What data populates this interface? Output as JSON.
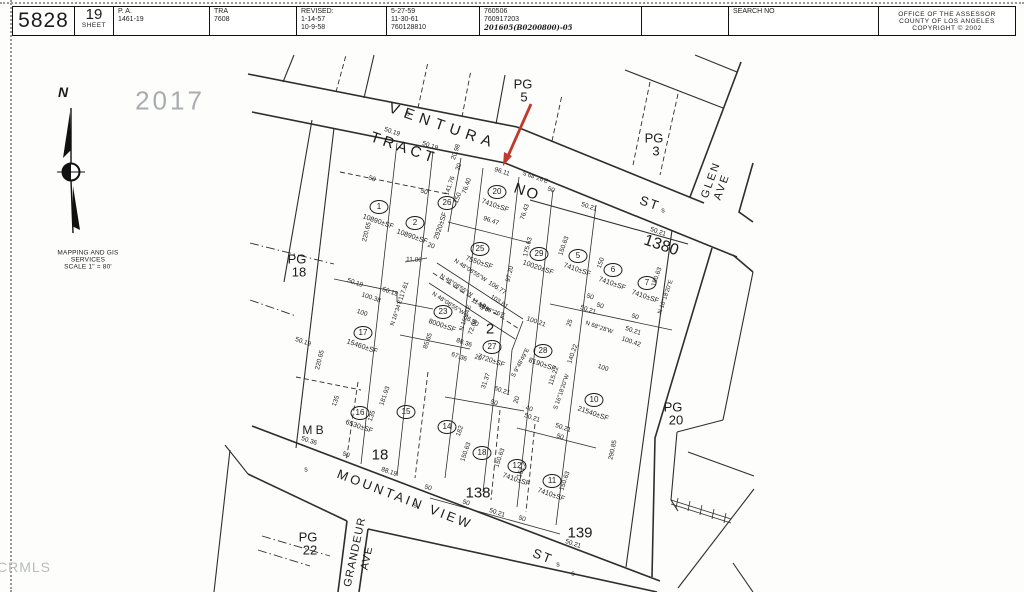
{
  "header": {
    "cells": [
      {
        "w": 62,
        "lines": [
          {
            "t": "5828",
            "cls": "xl"
          }
        ]
      },
      {
        "w": 39,
        "lines": [
          {
            "t": "19",
            "cls": "lg"
          },
          {
            "t": "SHEET",
            "cls": "cap"
          }
        ]
      },
      {
        "w": 96,
        "lines": [
          {
            "t": "P. A."
          },
          {
            "t": "1461-19"
          }
        ]
      },
      {
        "w": 87,
        "lines": [
          {
            "t": "TRA"
          },
          {
            "t": "7608"
          }
        ]
      },
      {
        "w": 90,
        "lines": [
          {
            "t": "REVISED:"
          },
          {
            "t": "1-14-57"
          },
          {
            "t": "10-9-58"
          }
        ]
      },
      {
        "w": 93,
        "lines": [
          {
            "t": "5-27-59"
          },
          {
            "t": "11-30-61"
          },
          {
            "t": "760128810"
          }
        ]
      },
      {
        "w": 162,
        "lines": [
          {
            "t": "760506"
          },
          {
            "t": "760917203"
          },
          {
            "t": "201605(B0200800)-05",
            "cls": "hand"
          }
        ]
      },
      {
        "w": 87,
        "lines": []
      },
      {
        "w": 150,
        "lines": [
          {
            "t": "SEARCH NO"
          }
        ]
      },
      {
        "w": 136,
        "align": "center",
        "lines": [
          {
            "t": "OFFICE OF THE ASSESSOR",
            "cls": "cap"
          },
          {
            "t": "COUNTY OF LOS ANGELES",
            "cls": "cap"
          },
          {
            "t": "COPYRIGHT © 2002",
            "cls": "cap"
          }
        ]
      }
    ]
  },
  "compass": {
    "north": "N",
    "caption1": "MAPPING AND GIS",
    "caption2": "SERVICES",
    "caption3": "SCALE 1\" = 80'"
  },
  "stamp": "2017",
  "watermark": "CRMLS",
  "map": {
    "arrow_color": "#c0392b",
    "labels": [
      {
        "t": "VENTURA",
        "x": 443,
        "y": 126,
        "r": 19,
        "k": "st",
        "s": 15,
        "ls": 6
      },
      {
        "t": "ST",
        "x": 650,
        "y": 203,
        "r": 19,
        "k": "st",
        "s": 13
      },
      {
        "t": "TRACT",
        "x": 404,
        "y": 148,
        "r": 19,
        "k": "st",
        "s": 15,
        "ls": 4
      },
      {
        "t": "NO",
        "x": 527,
        "y": 192,
        "r": 19,
        "k": "st",
        "s": 15
      },
      {
        "t": "MOUNTAIN VIEW",
        "x": 405,
        "y": 499,
        "r": 21,
        "k": "st",
        "s": 13,
        "ls": 3
      },
      {
        "t": "ST",
        "x": 543,
        "y": 556,
        "r": 21,
        "k": "st",
        "s": 13
      },
      {
        "t": "GLEN",
        "x": 711,
        "y": 180,
        "r": -70,
        "k": "st",
        "s": 11,
        "ls": 2
      },
      {
        "t": "AVE",
        "x": 722,
        "y": 187,
        "r": -70,
        "k": "st",
        "s": 11,
        "ls": 2
      },
      {
        "t": "GRANDEUR",
        "x": 355,
        "y": 552,
        "r": -78,
        "k": "st",
        "s": 11,
        "ls": 1
      },
      {
        "t": "AVE",
        "x": 367,
        "y": 558,
        "r": -78,
        "k": "st",
        "s": 11,
        "ls": 1
      },
      {
        "t": "PG",
        "x": 523,
        "y": 84,
        "k": "pg"
      },
      {
        "t": "5",
        "x": 524,
        "y": 97,
        "k": "pg"
      },
      {
        "t": "PG",
        "x": 654,
        "y": 138,
        "k": "pg"
      },
      {
        "t": "3",
        "x": 656,
        "y": 151,
        "k": "pg"
      },
      {
        "t": "PG",
        "x": 297,
        "y": 259,
        "k": "pg"
      },
      {
        "t": "18",
        "x": 299,
        "y": 272,
        "k": "pg"
      },
      {
        "t": "PG",
        "x": 673,
        "y": 407,
        "k": "pg"
      },
      {
        "t": "20",
        "x": 676,
        "y": 420,
        "k": "pg"
      },
      {
        "t": "PG",
        "x": 308,
        "y": 537,
        "k": "pg"
      },
      {
        "t": "22",
        "x": 310,
        "y": 550,
        "k": "pg"
      },
      {
        "t": "1380",
        "x": 661,
        "y": 246,
        "r": 19,
        "k": "blk",
        "s": 16
      },
      {
        "t": "2",
        "x": 490,
        "y": 329,
        "k": "blk"
      },
      {
        "t": "18",
        "x": 380,
        "y": 455,
        "k": "blk"
      },
      {
        "t": "138",
        "x": 478,
        "y": 493,
        "k": "blk"
      },
      {
        "t": "139",
        "x": 580,
        "y": 533,
        "k": "blk"
      },
      {
        "t": "M B",
        "x": 313,
        "y": 430,
        "k": "blk",
        "s": 12
      },
      {
        "t": "s",
        "x": 408,
        "y": 114,
        "k": "smark"
      },
      {
        "t": "s",
        "x": 663,
        "y": 211,
        "k": "smark"
      },
      {
        "t": "s",
        "x": 306,
        "y": 470,
        "k": "smark"
      },
      {
        "t": "s",
        "x": 415,
        "y": 506,
        "k": "smark"
      },
      {
        "t": "s",
        "x": 558,
        "y": 565,
        "k": "smark"
      },
      {
        "t": "s",
        "x": 573,
        "y": 574,
        "k": "smark"
      },
      {
        "t": "50.19",
        "x": 392,
        "y": 132,
        "r": 19,
        "k": "dim"
      },
      {
        "t": "50.19",
        "x": 430,
        "y": 146,
        "r": 19,
        "k": "dim"
      },
      {
        "t": "20.98",
        "x": 456,
        "y": 152,
        "r": -71,
        "k": "dim"
      },
      {
        "t": "20",
        "x": 459,
        "y": 167,
        "r": -71,
        "k": "dim"
      },
      {
        "t": "96.11",
        "x": 502,
        "y": 172,
        "r": 19,
        "k": "dim"
      },
      {
        "t": "S 68°26'E",
        "x": 535,
        "y": 178,
        "r": 19,
        "k": "brg"
      },
      {
        "t": "50",
        "x": 372,
        "y": 179,
        "r": 19,
        "k": "dim"
      },
      {
        "t": "50",
        "x": 424,
        "y": 192,
        "r": 19,
        "k": "dim"
      },
      {
        "t": "50",
        "x": 551,
        "y": 190,
        "r": 19,
        "k": "dim"
      },
      {
        "t": "50.21",
        "x": 589,
        "y": 207,
        "r": 19,
        "k": "dim"
      },
      {
        "t": "50.21",
        "x": 658,
        "y": 232,
        "r": 19,
        "k": "dim"
      },
      {
        "t": "141.76",
        "x": 450,
        "y": 186,
        "r": -71,
        "k": "dim"
      },
      {
        "t": "150",
        "x": 458,
        "y": 198,
        "r": -71,
        "k": "dim"
      },
      {
        "t": "76.40",
        "x": 467,
        "y": 186,
        "r": -71,
        "k": "dim"
      },
      {
        "t": "96.47",
        "x": 491,
        "y": 221,
        "r": 19,
        "k": "dim"
      },
      {
        "t": "76.43",
        "x": 525,
        "y": 212,
        "r": -71,
        "k": "dim"
      },
      {
        "t": "220.65",
        "x": 367,
        "y": 232,
        "r": -76,
        "k": "dim"
      },
      {
        "t": "11.06",
        "x": 414,
        "y": 260,
        "r": 3,
        "k": "dim"
      },
      {
        "t": "20",
        "x": 431,
        "y": 246,
        "r": 19,
        "k": "dim"
      },
      {
        "t": "175.63",
        "x": 528,
        "y": 247,
        "r": -76,
        "k": "dim"
      },
      {
        "t": "97.20",
        "x": 510,
        "y": 274,
        "r": -76,
        "k": "dim"
      },
      {
        "t": "N 48°08'55\"W",
        "x": 470,
        "y": 271,
        "r": 33,
        "k": "brg"
      },
      {
        "t": "106.77",
        "x": 497,
        "y": 288,
        "r": 33,
        "k": "dim"
      },
      {
        "t": "N 48°08'55\"W",
        "x": 456,
        "y": 286,
        "r": 33,
        "k": "brg"
      },
      {
        "t": "103.81",
        "x": 499,
        "y": 302,
        "r": 33,
        "k": "dim"
      },
      {
        "t": "114.89",
        "x": 480,
        "y": 305,
        "r": 33,
        "k": "dim"
      },
      {
        "t": "N 48°08'55\"W",
        "x": 448,
        "y": 304,
        "r": 33,
        "k": "brg"
      },
      {
        "t": "86.30",
        "x": 471,
        "y": 321,
        "r": 33,
        "k": "dim"
      },
      {
        "t": "150.63",
        "x": 564,
        "y": 246,
        "r": -71,
        "k": "dim"
      },
      {
        "t": "150",
        "x": 601,
        "y": 263,
        "r": -71,
        "k": "dim"
      },
      {
        "t": "150.63",
        "x": 657,
        "y": 277,
        "r": -71,
        "k": "dim"
      },
      {
        "t": "N 16°18'20\"E",
        "x": 666,
        "y": 297,
        "r": -71,
        "k": "brg"
      },
      {
        "t": "50",
        "x": 590,
        "y": 297,
        "r": 19,
        "k": "dim"
      },
      {
        "t": "50.21",
        "x": 588,
        "y": 310,
        "r": 19,
        "k": "dim"
      },
      {
        "t": "50",
        "x": 635,
        "y": 317,
        "r": 19,
        "k": "dim"
      },
      {
        "t": "50.21",
        "x": 633,
        "y": 331,
        "r": 19,
        "k": "dim"
      },
      {
        "t": "100.42",
        "x": 631,
        "y": 342,
        "r": 19,
        "k": "dim"
      },
      {
        "t": "N 68°28'W",
        "x": 599,
        "y": 328,
        "r": 19,
        "k": "brg"
      },
      {
        "t": "50.19",
        "x": 303,
        "y": 342,
        "r": 19,
        "k": "dim"
      },
      {
        "t": "50.19",
        "x": 355,
        "y": 283,
        "r": 19,
        "k": "dim"
      },
      {
        "t": "100.38",
        "x": 371,
        "y": 298,
        "r": 19,
        "k": "dim"
      },
      {
        "t": "50.19",
        "x": 390,
        "y": 292,
        "r": 19,
        "k": "dim"
      },
      {
        "t": "100",
        "x": 362,
        "y": 313,
        "r": 19,
        "k": "dim"
      },
      {
        "t": "117.61",
        "x": 404,
        "y": 291,
        "r": -71,
        "k": "dim"
      },
      {
        "t": "N 16°34'E",
        "x": 397,
        "y": 313,
        "r": -71,
        "k": "brg"
      },
      {
        "t": "220.65",
        "x": 320,
        "y": 360,
        "r": -76,
        "k": "dim"
      },
      {
        "t": "85.65",
        "x": 428,
        "y": 341,
        "r": -71,
        "k": "dim"
      },
      {
        "t": "88.36",
        "x": 464,
        "y": 343,
        "r": 19,
        "k": "dim"
      },
      {
        "t": "67.36",
        "x": 459,
        "y": 357,
        "r": 19,
        "k": "dim"
      },
      {
        "t": "N 16°34'E",
        "x": 466,
        "y": 318,
        "r": -71,
        "k": "brg"
      },
      {
        "t": "72.68",
        "x": 473,
        "y": 327,
        "r": -71,
        "k": "dim"
      },
      {
        "t": "29",
        "x": 478,
        "y": 358,
        "r": 19,
        "k": "dim"
      },
      {
        "t": "S 68°26'E",
        "x": 492,
        "y": 312,
        "r": 19,
        "k": "brg"
      },
      {
        "t": "19",
        "x": 482,
        "y": 306,
        "r": 19,
        "k": "dim"
      },
      {
        "t": "100.21",
        "x": 536,
        "y": 322,
        "r": 19,
        "k": "dim"
      },
      {
        "t": "25",
        "x": 570,
        "y": 323,
        "r": -71,
        "k": "dim"
      },
      {
        "t": "50",
        "x": 600,
        "y": 306,
        "r": 19,
        "k": "dim"
      },
      {
        "t": "100",
        "x": 603,
        "y": 368,
        "r": 19,
        "k": "dim"
      },
      {
        "t": "115.22",
        "x": 554,
        "y": 376,
        "r": -71,
        "k": "dim"
      },
      {
        "t": "S 16°18'20\"W",
        "x": 562,
        "y": 392,
        "r": -71,
        "k": "brg"
      },
      {
        "t": "140.22",
        "x": 573,
        "y": 354,
        "r": -71,
        "k": "dim"
      },
      {
        "t": "S 9°48'49\"E",
        "x": 521,
        "y": 363,
        "r": -62,
        "k": "brg"
      },
      {
        "t": "31.37",
        "x": 486,
        "y": 381,
        "r": -71,
        "k": "dim"
      },
      {
        "t": "60.21",
        "x": 502,
        "y": 391,
        "r": 19,
        "k": "dim"
      },
      {
        "t": "50",
        "x": 494,
        "y": 403,
        "r": 19,
        "k": "dim"
      },
      {
        "t": "20",
        "x": 517,
        "y": 400,
        "r": -71,
        "k": "dim"
      },
      {
        "t": "40",
        "x": 529,
        "y": 409,
        "r": 19,
        "k": "dim"
      },
      {
        "t": "50.21",
        "x": 532,
        "y": 418,
        "r": 19,
        "k": "dim"
      },
      {
        "t": "50.21",
        "x": 563,
        "y": 428,
        "r": 19,
        "k": "dim"
      },
      {
        "t": "50",
        "x": 560,
        "y": 437,
        "r": 19,
        "k": "dim"
      },
      {
        "t": "135",
        "x": 336,
        "y": 401,
        "r": -71,
        "k": "dim"
      },
      {
        "t": "135",
        "x": 372,
        "y": 416,
        "r": -71,
        "k": "dim"
      },
      {
        "t": "181.93",
        "x": 385,
        "y": 396,
        "r": -71,
        "k": "dim"
      },
      {
        "t": "182",
        "x": 460,
        "y": 431,
        "r": -71,
        "k": "dim"
      },
      {
        "t": "150.63",
        "x": 466,
        "y": 452,
        "r": -71,
        "k": "dim"
      },
      {
        "t": "150.63",
        "x": 500,
        "y": 458,
        "r": -71,
        "k": "dim"
      },
      {
        "t": "151.2",
        "x": 522,
        "y": 470,
        "r": -71,
        "k": "dim"
      },
      {
        "t": "150.63",
        "x": 565,
        "y": 481,
        "r": -71,
        "k": "dim"
      },
      {
        "t": "50.36",
        "x": 309,
        "y": 441,
        "r": 19,
        "k": "dim"
      },
      {
        "t": "50",
        "x": 346,
        "y": 455,
        "r": 19,
        "k": "dim"
      },
      {
        "t": "88.19",
        "x": 389,
        "y": 472,
        "r": 19,
        "k": "dim"
      },
      {
        "t": "50",
        "x": 428,
        "y": 488,
        "r": 19,
        "k": "dim"
      },
      {
        "t": "50",
        "x": 466,
        "y": 503,
        "r": 19,
        "k": "dim"
      },
      {
        "t": "50.21",
        "x": 497,
        "y": 513,
        "r": 19,
        "k": "dim"
      },
      {
        "t": "50",
        "x": 522,
        "y": 519,
        "r": 19,
        "k": "dim"
      },
      {
        "t": "50.21",
        "x": 573,
        "y": 544,
        "r": 19,
        "k": "dim"
      },
      {
        "t": "290.85",
        "x": 613,
        "y": 450,
        "r": -78,
        "k": "dim"
      }
    ],
    "parcels": [
      {
        "n": "1",
        "x": 379,
        "y": 207,
        "sf": "10890±SF",
        "sx": 378,
        "sy": 222,
        "sr": 19
      },
      {
        "n": "2",
        "x": 415,
        "y": 223,
        "sf": "10890±SF",
        "sx": 412,
        "sy": 237,
        "sr": 19
      },
      {
        "n": "26",
        "x": 447,
        "y": 203,
        "sf": "2920±SF",
        "sx": 441,
        "sy": 226,
        "sr": -71
      },
      {
        "n": "20",
        "x": 497,
        "y": 192,
        "sf": "7410±SF",
        "sx": 495,
        "sy": 206,
        "sr": 19
      },
      {
        "n": "25",
        "x": 480,
        "y": 249,
        "sf": "7550±SF",
        "sx": 479,
        "sy": 263,
        "sr": 19
      },
      {
        "n": "29",
        "x": 539,
        "y": 254,
        "sf": "10020±SF",
        "sx": 538,
        "sy": 268,
        "sr": 19
      },
      {
        "n": "5",
        "x": 578,
        "y": 256,
        "sf": "7410±SF",
        "sx": 577,
        "sy": 270,
        "sr": 19
      },
      {
        "n": "6",
        "x": 613,
        "y": 270,
        "sf": "7410±SF",
        "sx": 612,
        "sy": 284,
        "sr": 19
      },
      {
        "n": "7",
        "x": 647,
        "y": 283,
        "sf": "7410±SF",
        "sx": 645,
        "sy": 297,
        "sr": 19
      },
      {
        "n": "23",
        "x": 443,
        "y": 312,
        "sf": "8000±SF",
        "sx": 442,
        "sy": 326,
        "sr": 19
      },
      {
        "n": "17",
        "x": 363,
        "y": 333,
        "sf": "15460±SF",
        "sx": 362,
        "sy": 347,
        "sr": 19
      },
      {
        "n": "27",
        "x": 492,
        "y": 347,
        "sf": "7720±SF",
        "sx": 491,
        "sy": 361,
        "sr": 19
      },
      {
        "n": "28",
        "x": 543,
        "y": 351,
        "sf": "8190±SF",
        "sx": 542,
        "sy": 365,
        "sr": 19
      },
      {
        "n": "10",
        "x": 594,
        "y": 400,
        "sf": "21540±SF",
        "sx": 593,
        "sy": 414,
        "sr": 19
      },
      {
        "n": "16",
        "x": 360,
        "y": 413,
        "sf": "6530±SF",
        "sx": 359,
        "sy": 427,
        "sr": 19
      },
      {
        "n": "15",
        "x": 406,
        "y": 412,
        "sf": null
      },
      {
        "n": "14",
        "x": 447,
        "y": 427,
        "sf": null
      },
      {
        "n": "18",
        "x": 482,
        "y": 453,
        "sf": null
      },
      {
        "n": "12",
        "x": 517,
        "y": 466,
        "sf": "7410±SF",
        "sx": 516,
        "sy": 480,
        "sr": 19
      },
      {
        "n": "11",
        "x": 552,
        "y": 481,
        "sf": "7410±SF",
        "sx": 551,
        "sy": 495,
        "sr": 19
      }
    ]
  }
}
